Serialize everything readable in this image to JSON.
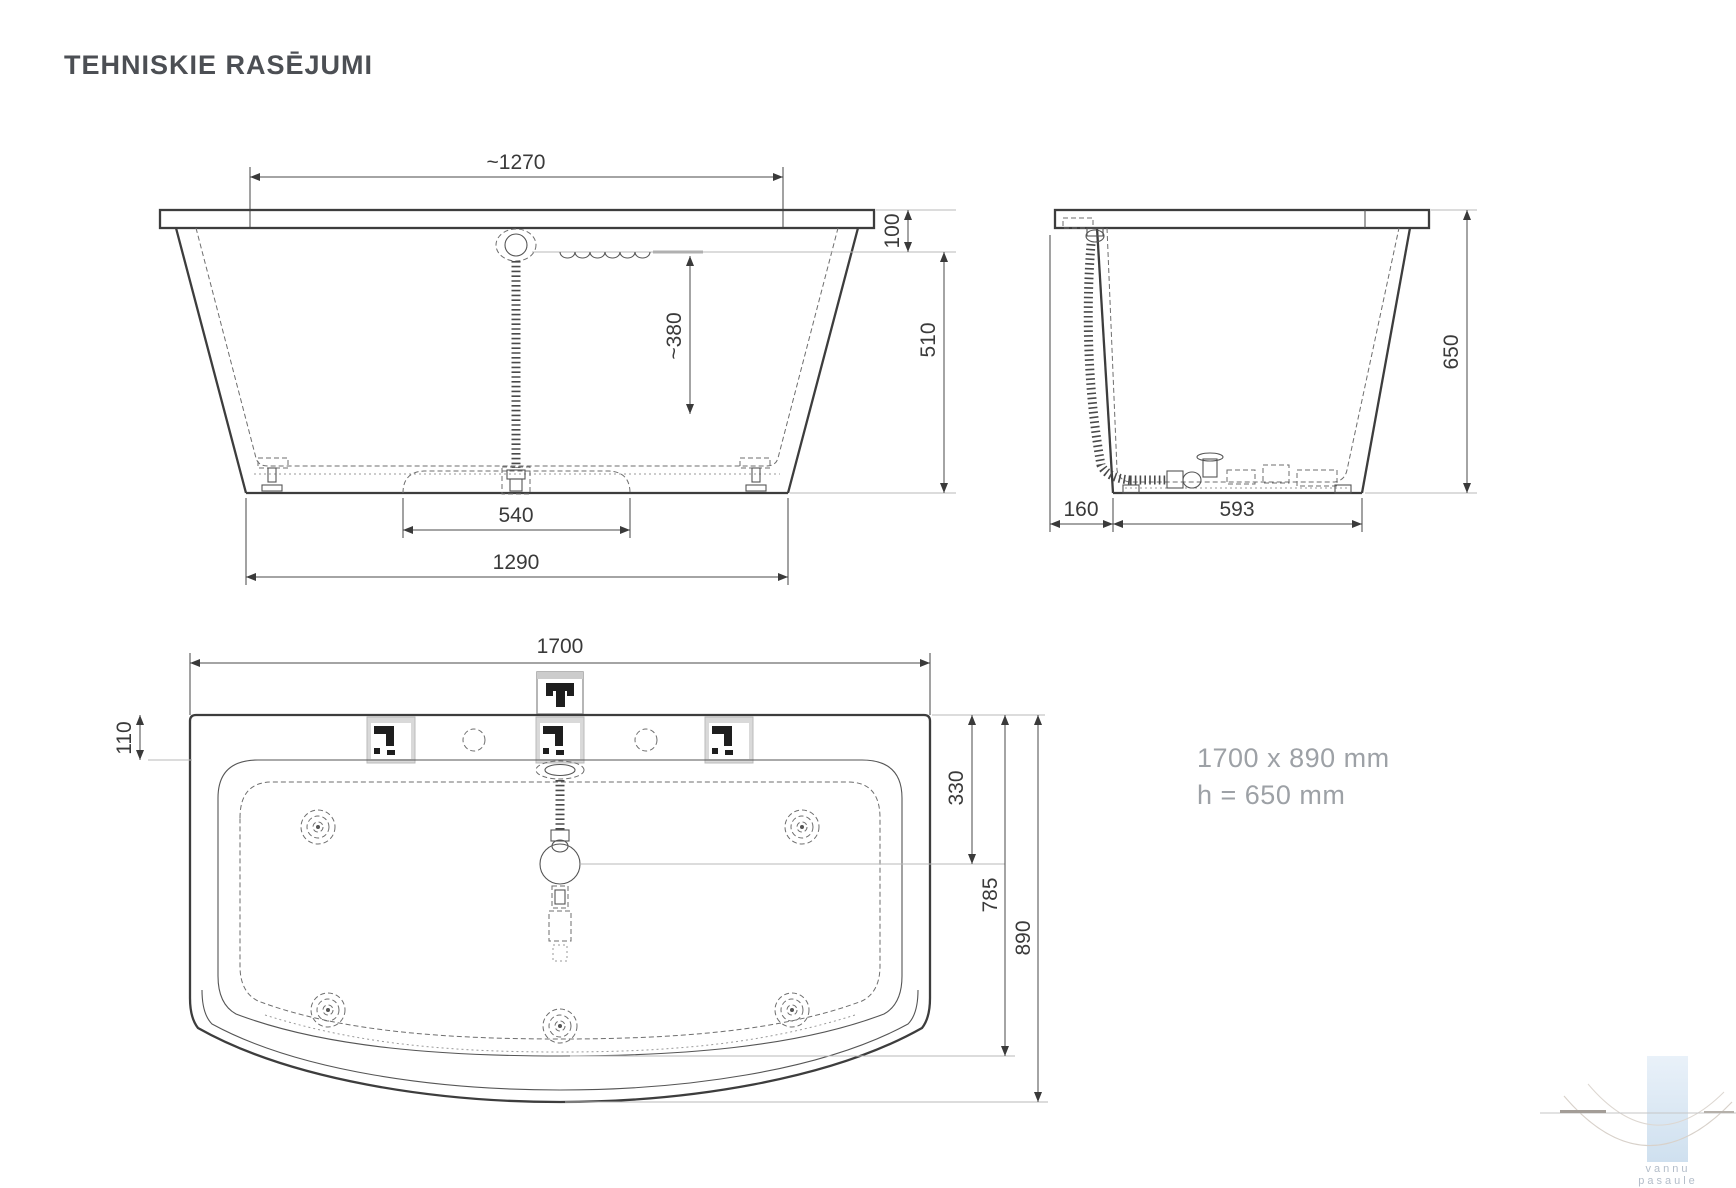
{
  "page": {
    "title": "TEHNISKIE RASĒJUMI"
  },
  "front_view": {
    "top_width": "~1270",
    "rim_height": "100",
    "depth_below_waterline": "510",
    "water_depth": "~380",
    "support_spacing": "540",
    "base_width": "1290"
  },
  "side_view": {
    "height": "650",
    "front_overhang": "160",
    "base_length": "593"
  },
  "top_view": {
    "length": "1700",
    "rim_width": "110",
    "drain_offset": "330",
    "inner_length": "785",
    "overall_width": "890"
  },
  "specs": {
    "size": "1700 x 890 mm",
    "height": "h = 650 mm"
  },
  "icons": {
    "faucet": "faucet-mount-icon",
    "bracket": "mounting-bracket-icon"
  },
  "colors": {
    "line": "#3d3d3d",
    "gray_text": "#9da1a6",
    "logo_band_top": "#e9f1f9",
    "logo_band_bottom": "#cfe0ef"
  },
  "logo": {
    "line1": "vannu",
    "line2": "pasaule"
  }
}
